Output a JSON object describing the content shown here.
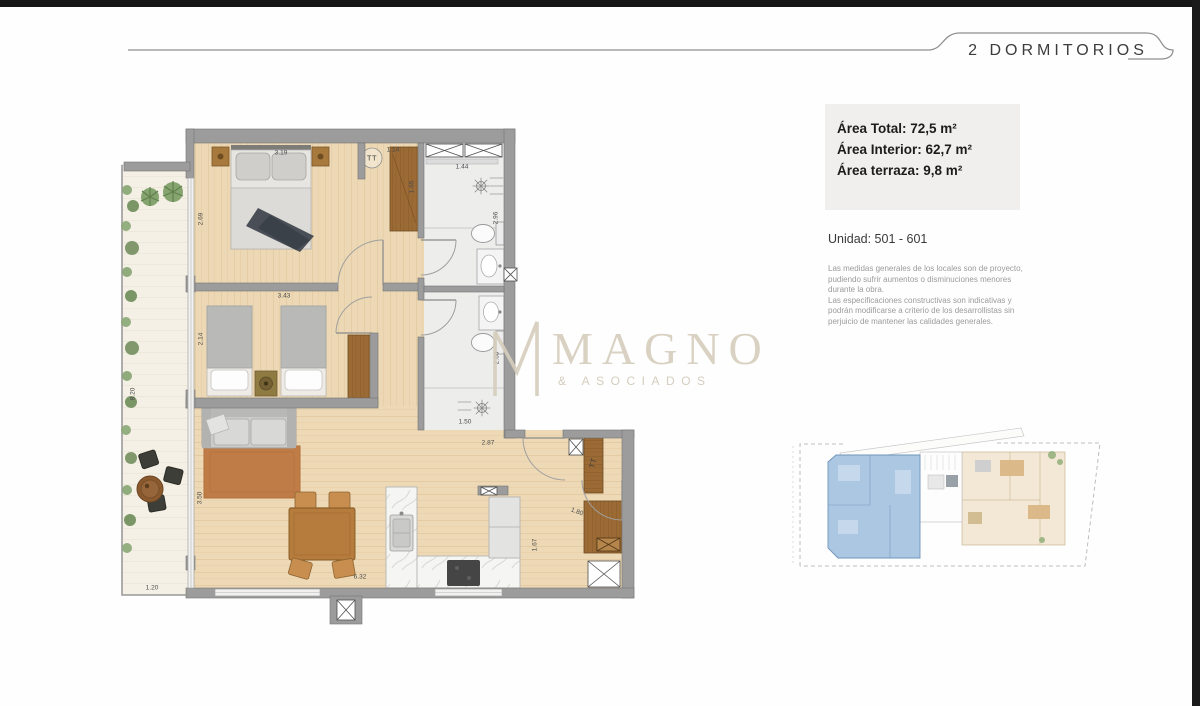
{
  "header": {
    "title": "2 DORMITORIOS"
  },
  "summary": {
    "area_total": "Área Total: 72,5 m²",
    "area_interior": "Área Interior: 62,7 m²",
    "area_terraza": "Área terraza: 9,8 m²",
    "unit": "Unidad: 501 - 601",
    "disclaimer_1": "Las medidas generales de los locales son de proyecto, pudiendo sufrir aumentos o disminuciones menores durante la obra.",
    "disclaimer_2": "Las especificaciones constructivas son indicativas y podrán modificarse a criterio de los desarrollistas sin perjuicio de mantener las calidades generales."
  },
  "logo": {
    "name": "MAGNO",
    "tagline": "& ASOCIADOS"
  },
  "floor_plan": {
    "dimension_labels": [
      {
        "text": "3.19",
        "x": 281,
        "y": 153,
        "rot": 0
      },
      {
        "text": "2.69",
        "x": 201,
        "y": 219,
        "rot": -90
      },
      {
        "text": "1.14",
        "x": 393,
        "y": 150,
        "rot": 0
      },
      {
        "text": "1.65",
        "x": 412,
        "y": 187,
        "rot": -90
      },
      {
        "text": "1.44",
        "x": 462,
        "y": 167,
        "rot": 0
      },
      {
        "text": "2.96",
        "x": 496,
        "y": 218,
        "rot": -90
      },
      {
        "text": "3.43",
        "x": 284,
        "y": 296,
        "rot": 0
      },
      {
        "text": "2.14",
        "x": 201,
        "y": 339,
        "rot": -90
      },
      {
        "text": "2.60",
        "x": 497,
        "y": 358,
        "rot": -90
      },
      {
        "text": "1.50",
        "x": 465,
        "y": 422,
        "rot": 0
      },
      {
        "text": "2.87",
        "x": 488,
        "y": 443,
        "rot": 0
      },
      {
        "text": "1.80",
        "x": 577,
        "y": 512,
        "rot": 20
      },
      {
        "text": "1.67",
        "x": 535,
        "y": 545,
        "rot": -90
      },
      {
        "text": "3.50",
        "x": 200,
        "y": 498,
        "rot": -90
      },
      {
        "text": "8.20",
        "x": 133,
        "y": 394,
        "rot": -90
      },
      {
        "text": "1.20",
        "x": 152,
        "y": 588,
        "rot": 0
      },
      {
        "text": "6.32",
        "x": 360,
        "y": 577,
        "rot": 0
      }
    ],
    "equipment_labels": [
      {
        "text": "TT",
        "x": 372,
        "y": 158,
        "rot": 0,
        "cls": "eq"
      },
      {
        "text": "TT",
        "x": 593,
        "y": 463,
        "rot": -75,
        "cls": "eq"
      }
    ]
  },
  "colors": {
    "wood_floor": "#ecd8b4",
    "terrace_floor": "#f4f0e5",
    "wall": "#9c9c9c",
    "closet_wood": "#9c6b35",
    "rug": "#c07c46",
    "bathroom_floor": "#ededec",
    "site_highlight": "#abc7e2",
    "accent_text": "#1c1c1c"
  }
}
